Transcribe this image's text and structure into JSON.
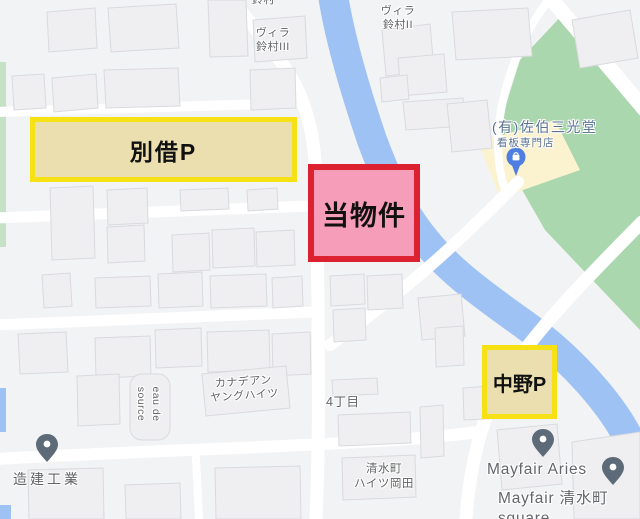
{
  "map": {
    "colors": {
      "lot": "#f2f3f5",
      "road": "#ffffff",
      "water": "#9ec2f3",
      "park": "#abd7af",
      "park_strip": "#c5e2c6",
      "building": "#efeff1",
      "building_stroke": "#d9dade",
      "commercial_lot": "#fbf2cf",
      "pin_gray": "#5c6b77",
      "pin_blue": "#4e7ee0",
      "label_gray": "#616365",
      "label_business": "#5a7392"
    },
    "labels": {
      "suzumura_clip": "鈴村",
      "villa_suzumura_3": "ヴィラ\n鈴村III",
      "villa_suzumura_2": "ヴィラ\n鈴村II",
      "saeki_title": "(有)佐伯三光堂",
      "saeki_sub": "看板専門店",
      "canadian_heights": "カナデアン\nヤングハイツ",
      "eau_de_source": "eau de\nsource",
      "yonchome": "4丁目",
      "zoken_kogyo": "造建工業",
      "shimizucho_heights": "清水町\nハイツ岡田",
      "mayfair_aries": "Mayfair Aries",
      "mayfair_square": "Mayfair 清水町 square"
    }
  },
  "annotations": {
    "betsukari": {
      "label": "別借P",
      "fill": "#ebdfb0",
      "border": "#f6e214"
    },
    "bukken": {
      "label": "当物件",
      "fill": "#f59db9",
      "border": "#dc2231"
    },
    "nakano": {
      "label": "中野P",
      "fill": "#ebdfb0",
      "border": "#f6e214"
    }
  }
}
